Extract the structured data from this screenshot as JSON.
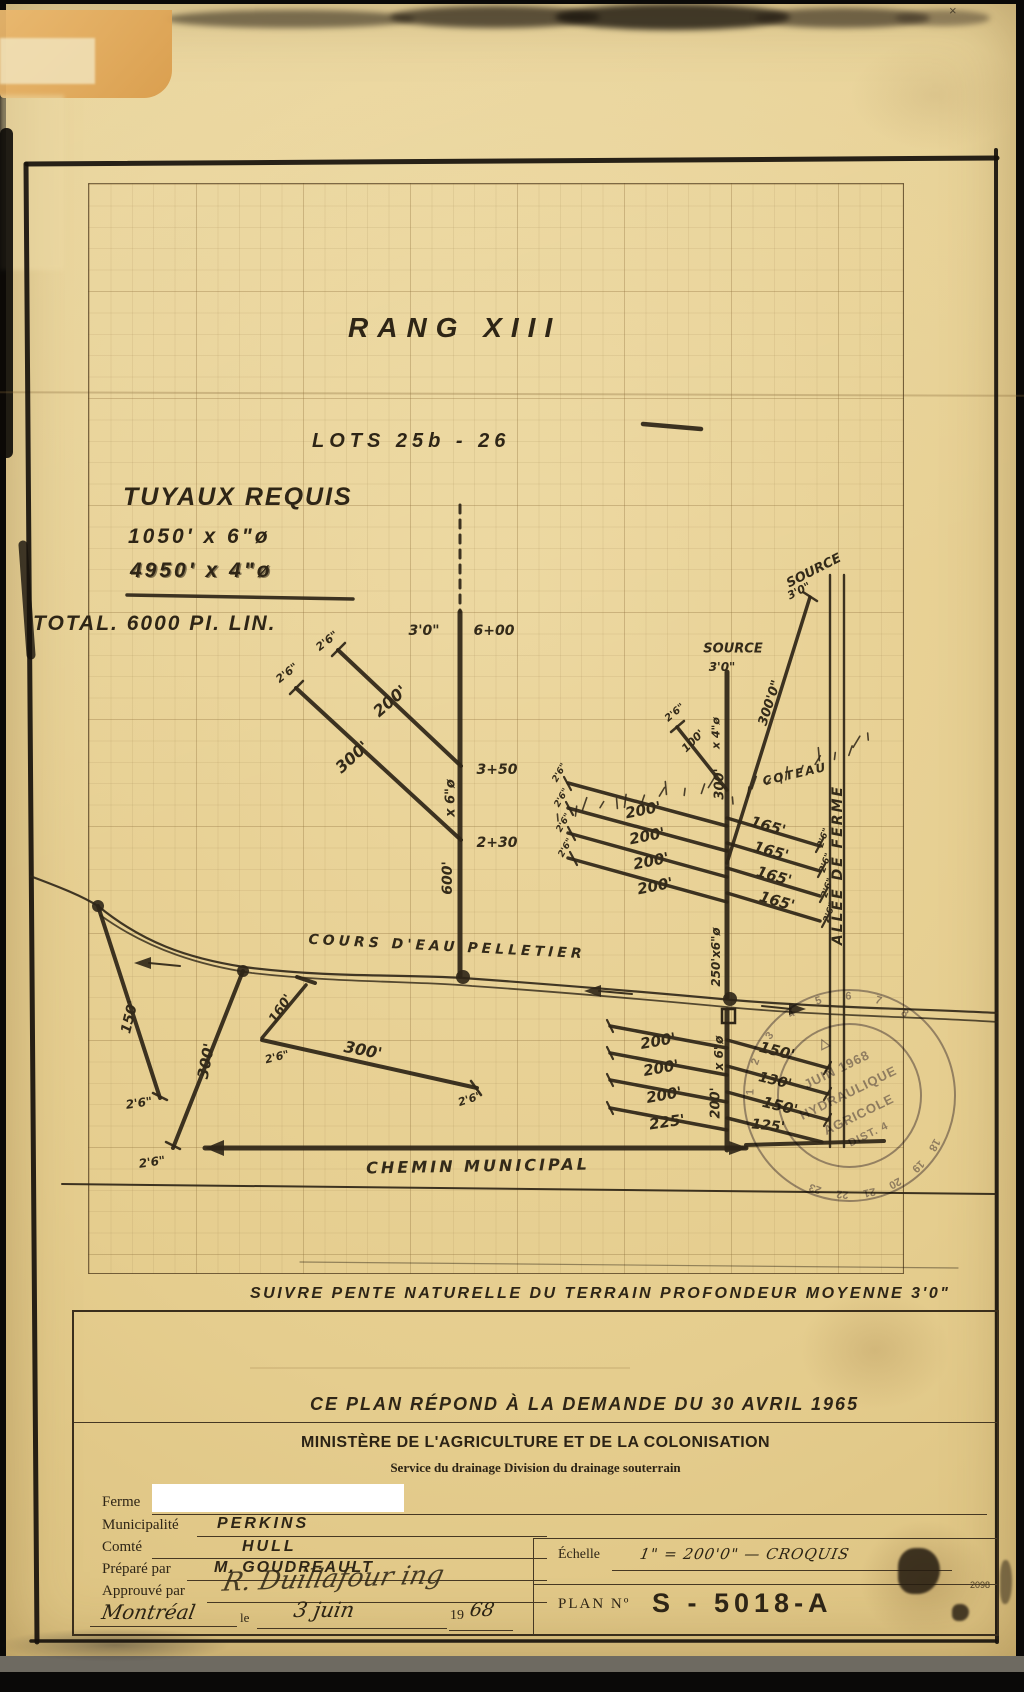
{
  "page": {
    "sheet_number": "2098"
  },
  "colors": {
    "paper": "#e6cf92",
    "ink": "#2e2517",
    "heavy": "#17120c",
    "stamp": "#6b6378",
    "grid": "#8f703c"
  },
  "titles": {
    "rang": "RANG XIII",
    "lots": "LOTS  25b - 26",
    "tuyaux_heading": "TUYAUX REQUIS",
    "tuyaux_line1": "1050' x 6\"ø",
    "tuyaux_line2": "4950' x 4\"ø",
    "total": "TOTAL. 6000 PI. LIN.",
    "note": "SUIVRE  PENTE  NATURELLE  DU TERRAIN   PROFONDEUR  MOYENNE  3'0\"",
    "demande": "CE PLAN  RÉPOND  À  LA  DEMANDE  DU  30 AVRIL 1965"
  },
  "title_block": {
    "ministry": "MINISTÈRE DE L'AGRICULTURE ET DE LA COLONISATION",
    "service": "Service du drainage  Division du drainage souterrain",
    "fields": [
      {
        "label": "Ferme",
        "value": ""
      },
      {
        "label": "Municipalité",
        "value": "PERKINS"
      },
      {
        "label": "Comté",
        "value": "HULL"
      },
      {
        "label": "Préparé par",
        "value": "M. GOUDREAULT"
      },
      {
        "label": "Approuvé par",
        "value": "R. Duillafour ing"
      }
    ],
    "place": "Montréal",
    "le": "le",
    "date_value": "3 juin",
    "year_prefix": "19",
    "year_suffix": "68",
    "echelle_label": "Échelle",
    "echelle_value": "1\" = 200'0\"   —   CROQUIS",
    "plan_label": "PLAN Nº",
    "plan_value": "S -  5018-A"
  },
  "stamp": {
    "symbol": "△",
    "month_year": "JUIN 1968",
    "line1": "HYDRAULIQUE",
    "line2": "AGRICOLE",
    "dist": "DIST. 4",
    "ring_numbers_top": [
      "1",
      "2",
      "3",
      "4",
      "5",
      "6",
      "7",
      "8"
    ],
    "ring_numbers_bottom": [
      "18",
      "19",
      "20",
      "21",
      "22",
      "23"
    ]
  },
  "diagram": {
    "labels": [
      {
        "t": "3'0\"",
        "x": 424,
        "y": 631,
        "r": 0,
        "s": 14
      },
      {
        "t": "6+00",
        "x": 494,
        "y": 631,
        "r": 0,
        "s": 14
      },
      {
        "t": "3+50",
        "x": 497,
        "y": 770,
        "r": 0,
        "s": 14
      },
      {
        "t": "2+30",
        "x": 497,
        "y": 843,
        "r": 0,
        "s": 14
      },
      {
        "t": "x 6\"ø",
        "x": 451,
        "y": 798,
        "r": -90,
        "s": 13
      },
      {
        "t": "600'",
        "x": 448,
        "y": 878,
        "r": -90,
        "s": 14
      },
      {
        "t": "200'",
        "x": 390,
        "y": 701,
        "r": -41,
        "s": 16
      },
      {
        "t": "2'6\"",
        "x": 327,
        "y": 641,
        "r": -38,
        "s": 11
      },
      {
        "t": "300'",
        "x": 352,
        "y": 757,
        "r": -42,
        "s": 16
      },
      {
        "t": "2'6\"",
        "x": 287,
        "y": 673,
        "r": -38,
        "s": 11
      },
      {
        "t": "SOURCE",
        "x": 733,
        "y": 649,
        "r": 0,
        "s": 13
      },
      {
        "t": "3'0\"",
        "x": 722,
        "y": 667,
        "r": 0,
        "s": 12
      },
      {
        "t": "SOURCE",
        "x": 814,
        "y": 571,
        "r": -27,
        "s": 13
      },
      {
        "t": "3'0\"",
        "x": 799,
        "y": 591,
        "r": -27,
        "s": 11
      },
      {
        "t": "300'0\"",
        "x": 770,
        "y": 703,
        "r": -72,
        "s": 13
      },
      {
        "t": "2'6\"",
        "x": 675,
        "y": 713,
        "r": -40,
        "s": 10
      },
      {
        "t": "100'",
        "x": 693,
        "y": 741,
        "r": -45,
        "s": 11
      },
      {
        "t": "x 4\"ø",
        "x": 716,
        "y": 733,
        "r": -90,
        "s": 11
      },
      {
        "t": "300'",
        "x": 720,
        "y": 784,
        "r": -90,
        "s": 13
      },
      {
        "t": "COTEAU",
        "x": 795,
        "y": 774,
        "r": -13,
        "s": 12,
        "ls": 2
      },
      {
        "t": "200'",
        "x": 643,
        "y": 810,
        "r": -11,
        "s": 15
      },
      {
        "t": "200'",
        "x": 647,
        "y": 836,
        "r": -11,
        "s": 15
      },
      {
        "t": "200'",
        "x": 651,
        "y": 861,
        "r": -11,
        "s": 15
      },
      {
        "t": "200'",
        "x": 655,
        "y": 886,
        "r": -11,
        "s": 15
      },
      {
        "t": "2'6\"",
        "x": 560,
        "y": 773,
        "r": -60,
        "s": 9
      },
      {
        "t": "2'6\"",
        "x": 562,
        "y": 798,
        "r": -60,
        "s": 9
      },
      {
        "t": "2'6\"",
        "x": 564,
        "y": 823,
        "r": -60,
        "s": 9
      },
      {
        "t": "2'6\"",
        "x": 566,
        "y": 848,
        "r": -60,
        "s": 9
      },
      {
        "t": "165'",
        "x": 768,
        "y": 826,
        "r": 16,
        "s": 15
      },
      {
        "t": "165'",
        "x": 771,
        "y": 851,
        "r": 16,
        "s": 15
      },
      {
        "t": "165'",
        "x": 774,
        "y": 876,
        "r": 16,
        "s": 15
      },
      {
        "t": "165'",
        "x": 777,
        "y": 901,
        "r": 16,
        "s": 15
      },
      {
        "t": "2'6\"",
        "x": 824,
        "y": 838,
        "r": -70,
        "s": 9
      },
      {
        "t": "2'6\"",
        "x": 826,
        "y": 863,
        "r": -70,
        "s": 9
      },
      {
        "t": "2'6\"",
        "x": 828,
        "y": 888,
        "r": -70,
        "s": 9
      },
      {
        "t": "2'6\"",
        "x": 830,
        "y": 913,
        "r": -70,
        "s": 9
      },
      {
        "t": "250'x6\"ø",
        "x": 716,
        "y": 957,
        "r": -90,
        "s": 12
      },
      {
        "t": "x 6\"ø",
        "x": 719,
        "y": 1053,
        "r": -90,
        "s": 12
      },
      {
        "t": "200'",
        "x": 716,
        "y": 1103,
        "r": -90,
        "s": 13
      },
      {
        "t": "200'",
        "x": 658,
        "y": 1041,
        "r": -10,
        "s": 15
      },
      {
        "t": "200'",
        "x": 661,
        "y": 1068,
        "r": -10,
        "s": 15
      },
      {
        "t": "200'",
        "x": 664,
        "y": 1095,
        "r": -10,
        "s": 15
      },
      {
        "t": "225'",
        "x": 667,
        "y": 1122,
        "r": -8,
        "s": 15
      },
      {
        "t": "150'",
        "x": 777,
        "y": 1051,
        "r": 14,
        "s": 15
      },
      {
        "t": "130'",
        "x": 775,
        "y": 1081,
        "r": 14,
        "s": 14
      },
      {
        "t": "150'",
        "x": 780,
        "y": 1106,
        "r": 14,
        "s": 15
      },
      {
        "t": "125'",
        "x": 768,
        "y": 1126,
        "r": 6,
        "s": 14
      },
      {
        "t": "150'",
        "x": 130,
        "y": 1017,
        "r": -76,
        "s": 14
      },
      {
        "t": "2'6\"",
        "x": 139,
        "y": 1103,
        "r": -8,
        "s": 12
      },
      {
        "t": "300'",
        "x": 206,
        "y": 1061,
        "r": -79,
        "s": 15
      },
      {
        "t": "2'6\"",
        "x": 152,
        "y": 1162,
        "r": -8,
        "s": 12
      },
      {
        "t": "160'",
        "x": 281,
        "y": 1009,
        "r": -56,
        "s": 13
      },
      {
        "t": "2'6\"",
        "x": 277,
        "y": 1057,
        "r": -14,
        "s": 11
      },
      {
        "t": "300'",
        "x": 363,
        "y": 1050,
        "r": 11,
        "s": 16
      },
      {
        "t": "2'6\"",
        "x": 470,
        "y": 1099,
        "r": -18,
        "s": 11
      },
      {
        "t": "COURS D'EAU  PELLETIER",
        "x": 447,
        "y": 947,
        "r": 3,
        "s": 14,
        "ls": 4
      },
      {
        "t": "CHEMIN  MUNICIPAL",
        "x": 478,
        "y": 1166,
        "r": -1,
        "s": 16,
        "ls": 3
      },
      {
        "t": "ALLÉE DE FERME",
        "x": 838,
        "y": 865,
        "r": -90,
        "s": 14,
        "ls": 2
      }
    ],
    "lines": [
      {
        "a": [
          27,
          164
        ],
        "b": [
          997,
          158
        ],
        "w": 5,
        "c": "h"
      },
      {
        "a": [
          26,
          164
        ],
        "b": [
          37,
          1642
        ],
        "w": 5,
        "c": "h"
      },
      {
        "a": [
          996,
          150
        ],
        "b": [
          997,
          1642
        ],
        "w": 4,
        "c": "h"
      },
      {
        "a": [
          31,
          1641
        ],
        "b": [
          996,
          1641
        ],
        "w": 3.5,
        "c": "h"
      },
      {
        "a": [
          23,
          545
        ],
        "b": [
          31,
          655
        ],
        "w": 9,
        "c": "h",
        "o": 0.8
      },
      {
        "a": [
          643,
          424
        ],
        "b": [
          701,
          429
        ],
        "w": 4.5
      },
      {
        "a": [
          127,
          595
        ],
        "b": [
          353,
          599
        ],
        "w": 3.5
      },
      {
        "a": [
          460,
          505
        ],
        "b": [
          460,
          612
        ],
        "w": 3,
        "d": "8,7"
      },
      {
        "a": [
          460,
          612
        ],
        "b": [
          460,
          976
        ],
        "w": 5
      },
      {
        "a": [
          461,
          766
        ],
        "b": [
          338,
          650
        ],
        "w": 4
      },
      {
        "a": [
          461,
          840
        ],
        "b": [
          296,
          688
        ],
        "w": 4
      },
      {
        "a": [
          332,
          656
        ],
        "b": [
          345,
          643
        ],
        "w": 2.5
      },
      {
        "a": [
          290,
          694
        ],
        "b": [
          303,
          681
        ],
        "w": 2.5
      },
      {
        "a": [
          727,
          672
        ],
        "b": [
          727,
          997
        ],
        "w": 5
      },
      {
        "a": [
          727,
          1010
        ],
        "b": [
          727,
          1150
        ],
        "w": 5
      },
      {
        "a": [
          810,
          597
        ],
        "b": [
          727,
          863
        ],
        "w": 3.5
      },
      {
        "a": [
          803,
          592
        ],
        "b": [
          817,
          601
        ],
        "w": 2.5
      },
      {
        "a": [
          677,
          727
        ],
        "b": [
          727,
          790
        ],
        "w": 3.5
      },
      {
        "a": [
          671,
          732
        ],
        "b": [
          684,
          721
        ],
        "w": 2.5
      },
      {
        "a": [
          727,
          826
        ],
        "b": [
          568,
          783
        ],
        "w": 3.5
      },
      {
        "a": [
          727,
          851
        ],
        "b": [
          568,
          808
        ],
        "w": 3.5
      },
      {
        "a": [
          727,
          877
        ],
        "b": [
          568,
          833
        ],
        "w": 3.5
      },
      {
        "a": [
          727,
          902
        ],
        "b": [
          568,
          858
        ],
        "w": 3.5
      },
      {
        "a": [
          564,
          777
        ],
        "b": [
          571,
          790
        ],
        "w": 2.2
      },
      {
        "a": [
          566,
          802
        ],
        "b": [
          573,
          815
        ],
        "w": 2.2
      },
      {
        "a": [
          568,
          827
        ],
        "b": [
          575,
          840
        ],
        "w": 2.2
      },
      {
        "a": [
          570,
          852
        ],
        "b": [
          577,
          865
        ],
        "w": 2.2
      },
      {
        "a": [
          727,
          818
        ],
        "b": [
          820,
          846
        ],
        "w": 3.5
      },
      {
        "a": [
          727,
          843
        ],
        "b": [
          820,
          871
        ],
        "w": 3.5
      },
      {
        "a": [
          727,
          868
        ],
        "b": [
          820,
          896
        ],
        "w": 3.5
      },
      {
        "a": [
          727,
          893
        ],
        "b": [
          820,
          921
        ],
        "w": 3.5
      },
      {
        "a": [
          823,
          839
        ],
        "b": [
          816,
          852
        ],
        "w": 2.2
      },
      {
        "a": [
          825,
          864
        ],
        "b": [
          818,
          877
        ],
        "w": 2.2
      },
      {
        "a": [
          827,
          889
        ],
        "b": [
          820,
          902
        ],
        "w": 2.2
      },
      {
        "a": [
          829,
          914
        ],
        "b": [
          822,
          927
        ],
        "w": 2.2
      },
      {
        "a": [
          727,
          1048
        ],
        "b": [
          610,
          1026
        ],
        "w": 3.5
      },
      {
        "a": [
          727,
          1075
        ],
        "b": [
          610,
          1053
        ],
        "w": 3.5
      },
      {
        "a": [
          727,
          1102
        ],
        "b": [
          610,
          1080
        ],
        "w": 3.5
      },
      {
        "a": [
          727,
          1130
        ],
        "b": [
          610,
          1108
        ],
        "w": 3.5
      },
      {
        "a": [
          607,
          1020
        ],
        "b": [
          613,
          1032
        ],
        "w": 2.2
      },
      {
        "a": [
          607,
          1047
        ],
        "b": [
          613,
          1059
        ],
        "w": 2.2
      },
      {
        "a": [
          607,
          1074
        ],
        "b": [
          613,
          1086
        ],
        "w": 2.2
      },
      {
        "a": [
          607,
          1102
        ],
        "b": [
          613,
          1114
        ],
        "w": 2.2
      },
      {
        "a": [
          727,
          1040
        ],
        "b": [
          828,
          1068
        ],
        "w": 3.5
      },
      {
        "a": [
          727,
          1066
        ],
        "b": [
          828,
          1094
        ],
        "w": 3.5
      },
      {
        "a": [
          727,
          1092
        ],
        "b": [
          828,
          1120
        ],
        "w": 3.5
      },
      {
        "a": [
          727,
          1118
        ],
        "b": [
          822,
          1142
        ],
        "w": 3.5
      },
      {
        "a": [
          831,
          1062
        ],
        "b": [
          824,
          1074
        ],
        "w": 2.2
      },
      {
        "a": [
          831,
          1088
        ],
        "b": [
          824,
          1100
        ],
        "w": 2.2
      },
      {
        "a": [
          831,
          1114
        ],
        "b": [
          824,
          1126
        ],
        "w": 2.2
      },
      {
        "a": [
          830,
          575
        ],
        "b": [
          830,
          1147
        ],
        "w": 2.4
      },
      {
        "a": [
          844,
          575
        ],
        "b": [
          844,
          1147
        ],
        "w": 2.4
      },
      {
        "a": [
          205,
          1148
        ],
        "b": [
          746,
          1148
        ],
        "w": 5
      },
      {
        "a": [
          746,
          1145
        ],
        "b": [
          884,
          1141
        ],
        "w": 4
      },
      {
        "a": [
          62,
          1184
        ],
        "b": [
          996,
          1194
        ],
        "w": 2
      },
      {
        "a": [
          300,
          1262
        ],
        "b": [
          958,
          1268
        ],
        "w": 1.2,
        "o": 0.45
      },
      {
        "a": [
          98,
          906
        ],
        "b": [
          160,
          1098
        ],
        "w": 4
      },
      {
        "a": [
          153,
          1093
        ],
        "b": [
          167,
          1100
        ],
        "w": 2.5
      },
      {
        "a": [
          243,
          971
        ],
        "b": [
          173,
          1148
        ],
        "w": 4
      },
      {
        "a": [
          166,
          1142
        ],
        "b": [
          180,
          1149
        ],
        "w": 2.5
      },
      {
        "a": [
          306,
          985
        ],
        "b": [
          262,
          1038
        ],
        "w": 3.5
      },
      {
        "a": [
          297,
          977
        ],
        "b": [
          315,
          983
        ],
        "w": 4
      },
      {
        "a": [
          262,
          1040
        ],
        "b": [
          477,
          1088
        ],
        "w": 4
      },
      {
        "a": [
          471,
          1081
        ],
        "b": [
          481,
          1095
        ],
        "w": 2.5
      },
      {
        "a": [
          149,
          963
        ],
        "b": [
          180,
          966
        ],
        "w": 2
      },
      {
        "a": [
          599,
          991
        ],
        "b": [
          632,
          994
        ],
        "w": 2
      },
      {
        "a": [
          762,
          1006
        ],
        "b": [
          791,
          1009
        ],
        "w": 2
      }
    ],
    "paths": [
      {
        "d": "M30,876 C62,888 82,896 98,906 C142,942 186,958 244,967 C330,978 400,974 463,978 C560,985 646,992 732,1000 C830,1008 925,1009 998,1013",
        "w": 2.2
      },
      {
        "d": "M100,915 C150,951 204,966 252,973 C340,983 420,981 472,986 C574,993 652,1000 737,1008 C828,1016 926,1017 998,1022",
        "w": 1.8,
        "o": 0.8
      }
    ],
    "circles": [
      {
        "x": 98,
        "y": 906,
        "r": 6
      },
      {
        "x": 243,
        "y": 971,
        "r": 6
      },
      {
        "x": 463,
        "y": 977,
        "r": 7
      },
      {
        "x": 730,
        "y": 999,
        "r": 7
      }
    ],
    "rects": [
      {
        "x": 722,
        "y": 1009,
        "w": 13,
        "h": 14
      }
    ],
    "polys": [
      "205,1148 224,1140 224,1156",
      "748,1148 729,1141 729,1155",
      "134,963 151,957 151,969",
      "584,991 601,985 601,997",
      "806,1009 789,1003 789,1015"
    ],
    "hatch": [
      {
        "a": [
          558,
          818
        ],
        "b": [
          712,
          788
        ],
        "n": 12
      },
      {
        "a": [
          733,
          801
        ],
        "b": [
          868,
          743
        ],
        "n": 13
      }
    ]
  }
}
